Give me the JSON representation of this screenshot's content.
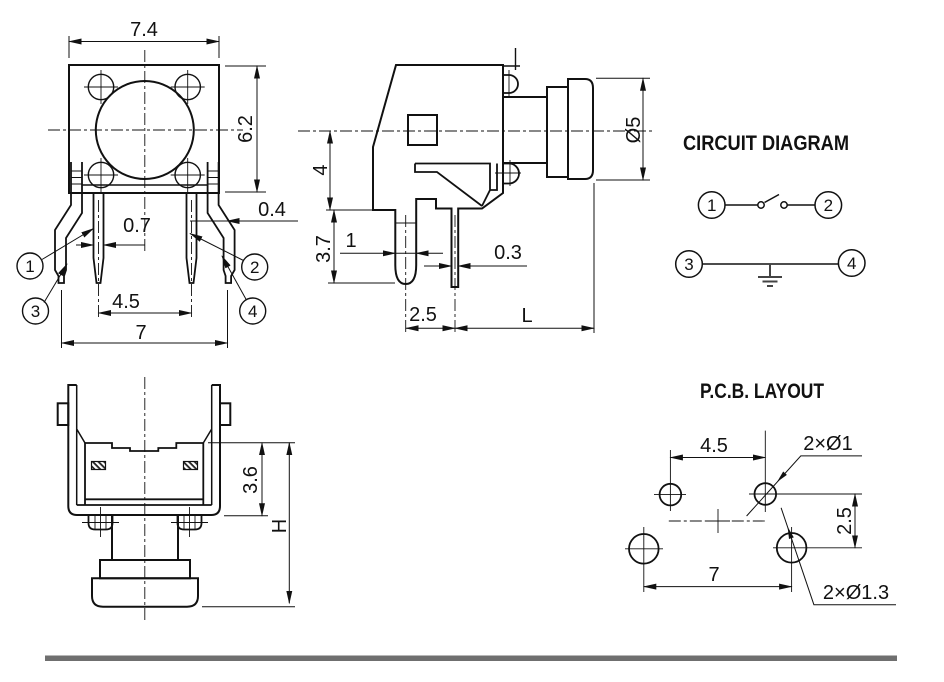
{
  "front_view": {
    "dim_width": "7.4",
    "dim_height": "6.2",
    "dim_pin_width": "0.7",
    "dim_leg_thickness": "0.4",
    "dim_inner_pin_spacing": "4.5",
    "dim_outer_pin_spacing": "7",
    "callouts": {
      "c1": "1",
      "c2": "2",
      "c3": "3",
      "c4": "4"
    }
  },
  "side_view": {
    "dim_center_to_base": "4",
    "dim_pin_length": "3.7",
    "dim_pin_width": "1",
    "dim_post_width": "0.3",
    "dim_pin_offset": "2.5",
    "dim_shaft_length": "L",
    "dim_button_diameter": "Ø5"
  },
  "bottom_view": {
    "dim_inner_depth": "3.6",
    "dim_total_height": "H"
  },
  "circuit_diagram": {
    "title": "CIRCUIT DIAGRAM",
    "terminals": {
      "t1": "1",
      "t2": "2",
      "t3": "3",
      "t4": "4"
    }
  },
  "pcb_layout": {
    "title": "P.C.B. LAYOUT",
    "dim_top_hole_spacing": "4.5",
    "dim_bottom_hole_spacing": "7",
    "dim_row_spacing": "2.5",
    "label_small_holes": "2×Ø1",
    "label_large_holes": "2×Ø1.3"
  },
  "colors": {
    "line": "#111111",
    "separator": "#6f6f6f",
    "background": "#ffffff"
  }
}
